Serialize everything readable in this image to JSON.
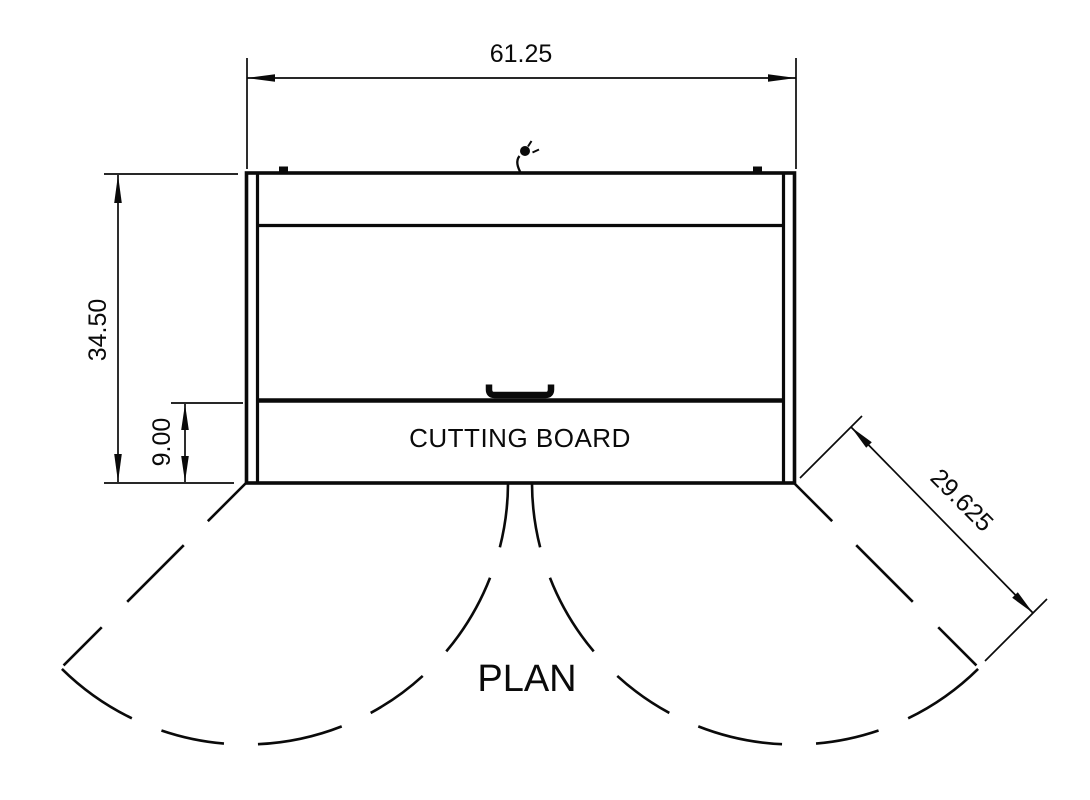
{
  "drawing": {
    "view_title": "PLAN",
    "labels": {
      "cutting_board": "CUTTING BOARD"
    },
    "dimensions": {
      "overall_width": "61.25",
      "overall_depth": "34.50",
      "cutting_board_depth": "9.00",
      "door_swing": "29.625"
    },
    "symbols": [
      "power-cord-icon",
      "hinge-icon",
      "door-handle-icon"
    ],
    "colors": {
      "line": "#0a0a0a",
      "background": "#ffffff"
    }
  }
}
